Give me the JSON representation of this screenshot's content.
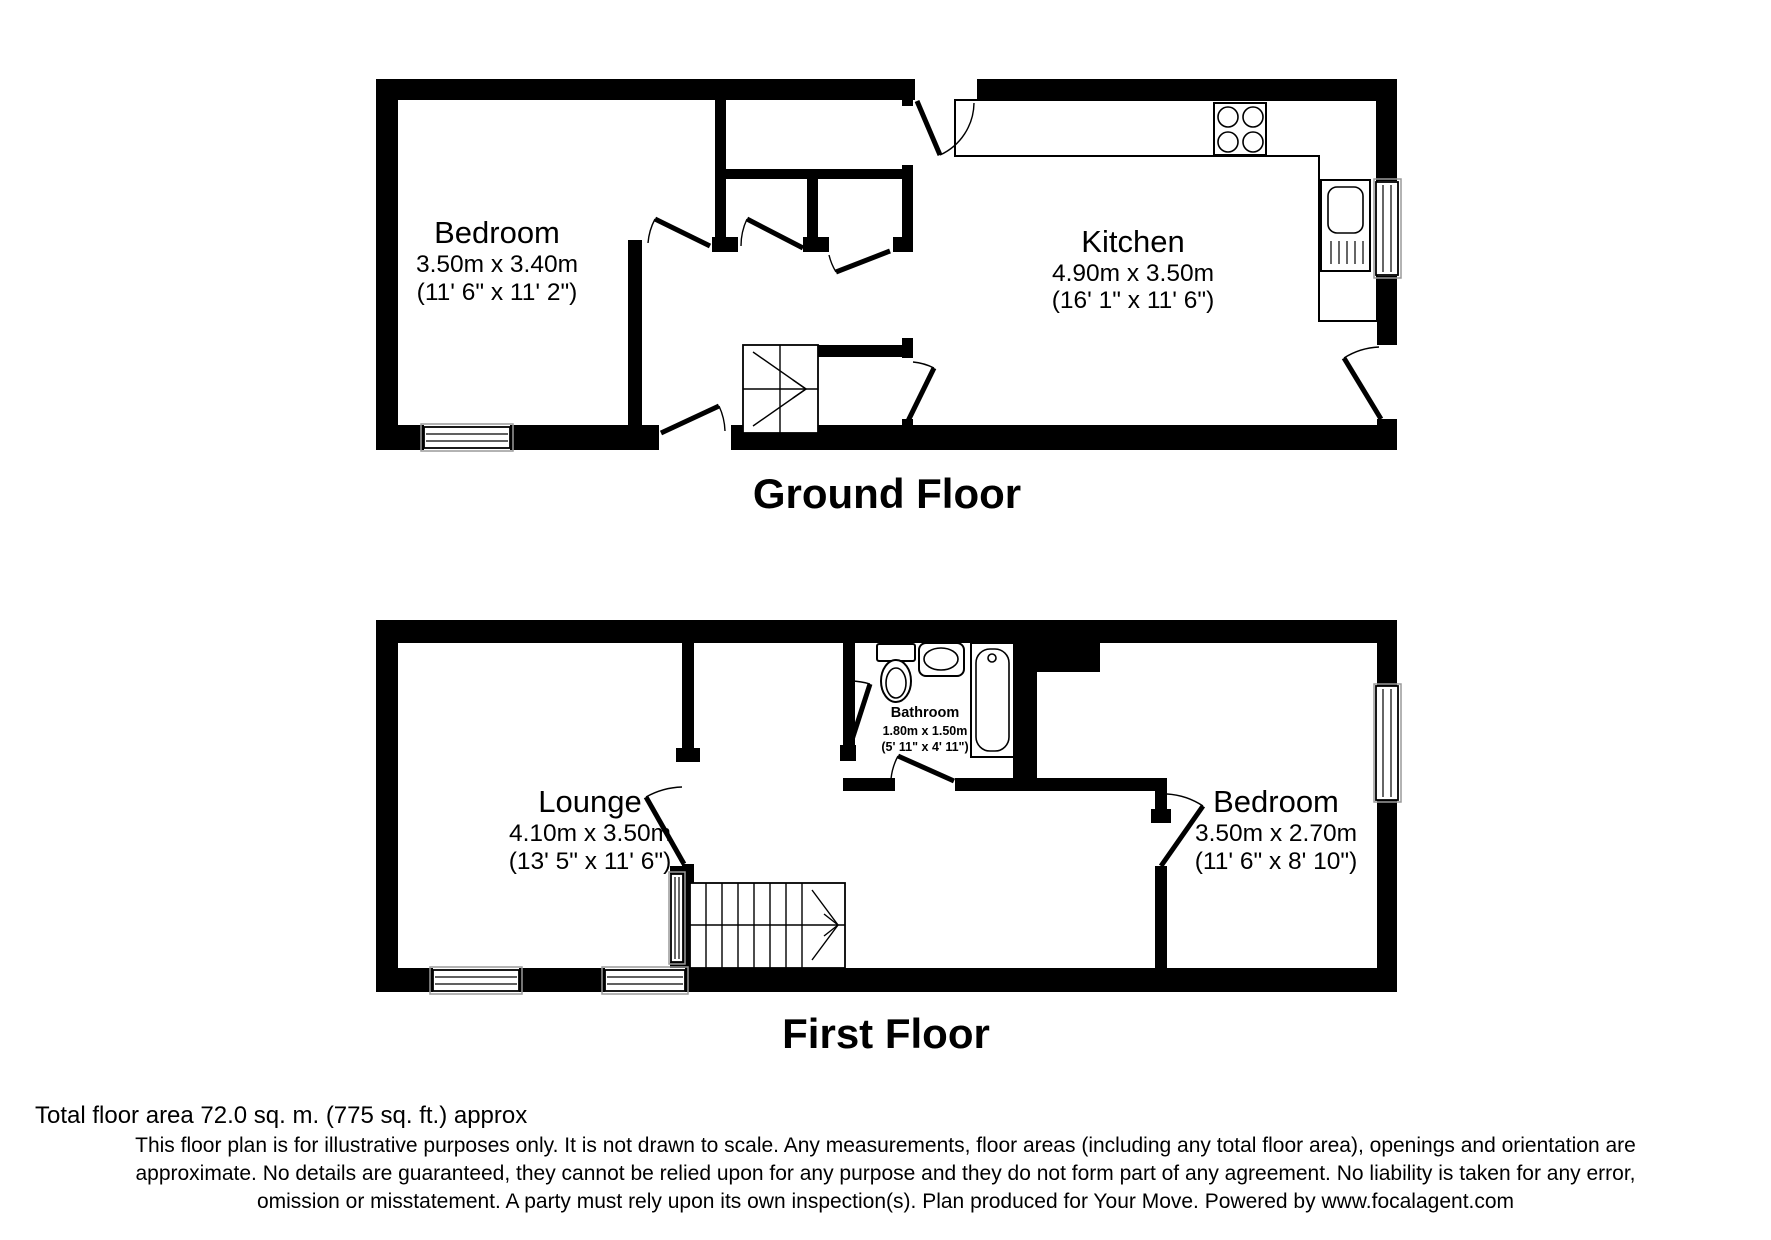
{
  "ground_floor": {
    "title": "Ground Floor",
    "bedroom": {
      "name": "Bedroom",
      "metric": "3.50m x 3.40m",
      "imperial": "(11' 6\" x 11' 2\")"
    },
    "kitchen": {
      "name": "Kitchen",
      "metric": "4.90m x 3.50m",
      "imperial": "(16' 1\" x 11' 6\")"
    }
  },
  "first_floor": {
    "title": "First Floor",
    "lounge": {
      "name": "Lounge",
      "metric": "4.10m x 3.50m",
      "imperial": "(13' 5\" x 11' 6\")"
    },
    "bathroom": {
      "name": "Bathroom",
      "metric": "1.80m x 1.50m",
      "imperial": "(5' 11\" x 4' 11\")"
    },
    "bedroom": {
      "name": "Bedroom",
      "metric": "3.50m x 2.70m",
      "imperial": "(11' 6\" x 8' 10\")"
    }
  },
  "footer": {
    "total_area": "Total floor area 72.0 sq. m. (775 sq. ft.) approx",
    "disclaimer_lines": [
      "This floor plan is for illustrative purposes only. It is not drawn to scale. Any measurements, floor areas (including any total floor area), openings and orientation are",
      "approximate. No details are guaranteed, they cannot be relied upon for any purpose and they do not form part of any agreement. No liability is taken for any error,",
      "omission or misstatement. A party must rely upon its own inspection(s). Plan produced for Your Move. Powered by www.focalagent.com"
    ]
  },
  "icons": {
    "hob": "hob-icon",
    "sink": "sink-icon",
    "toilet": "toilet-icon",
    "bath": "bath-icon",
    "basin": "basin-icon",
    "stairs": "stairs-icon",
    "window": "window-icon",
    "door": "door-arc-icon"
  },
  "colors": {
    "wall": "#000000",
    "background": "#ffffff",
    "window_frame": "#9a9a9a"
  }
}
